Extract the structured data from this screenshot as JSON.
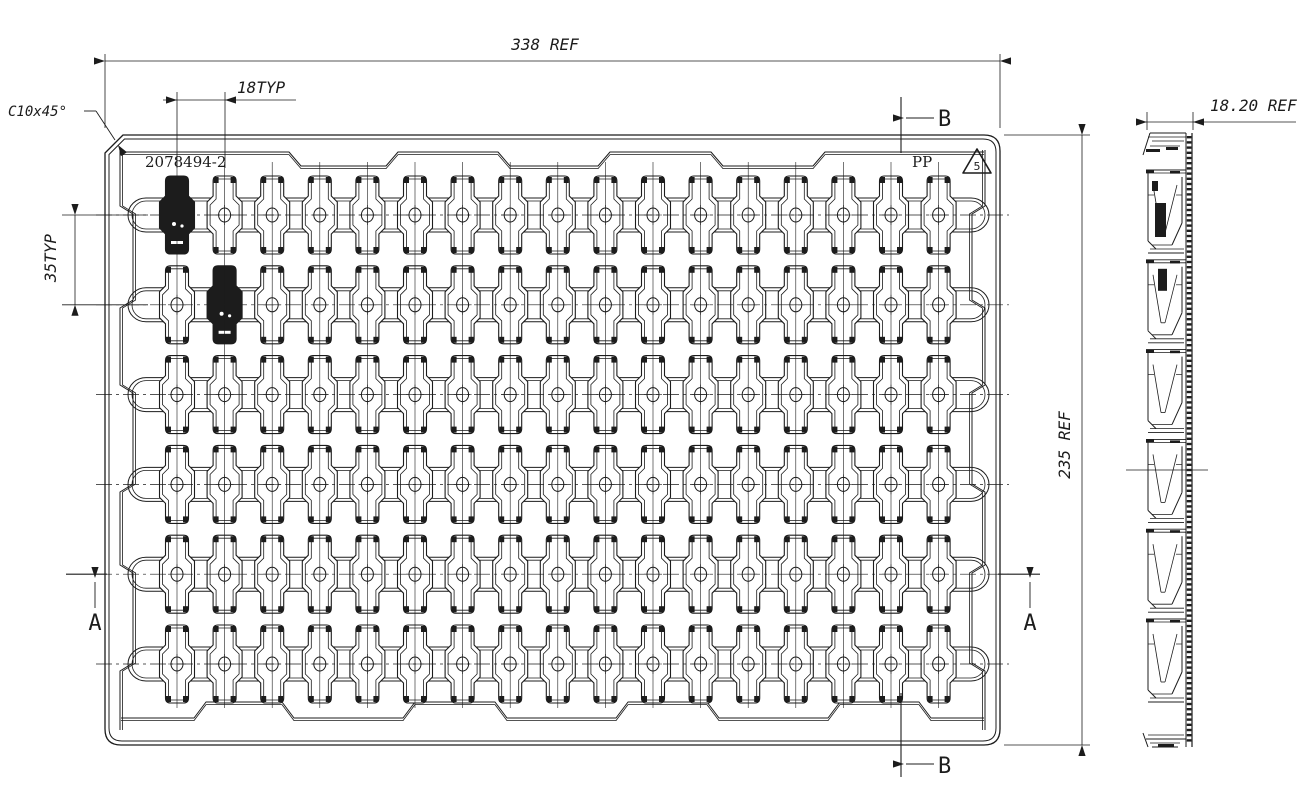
{
  "drawing": {
    "part_number": "2078494-2",
    "material": "PP",
    "resin_code": "5",
    "dims": {
      "overall_width": "338 REF",
      "overall_height": "235 REF",
      "pocket_pitch_x": "18TYP",
      "pocket_pitch_y": "35TYP",
      "corner_chamfer": "C10x45°",
      "side_thickness": "18.20 REF"
    },
    "sections": {
      "a": "A",
      "b": "B"
    },
    "grid": {
      "rows": 6,
      "cols": 17,
      "filled_pockets": [
        [
          0,
          0
        ],
        [
          1,
          1
        ]
      ]
    },
    "colors": {
      "line": "#1c1c1c",
      "background": "#ffffff"
    }
  }
}
